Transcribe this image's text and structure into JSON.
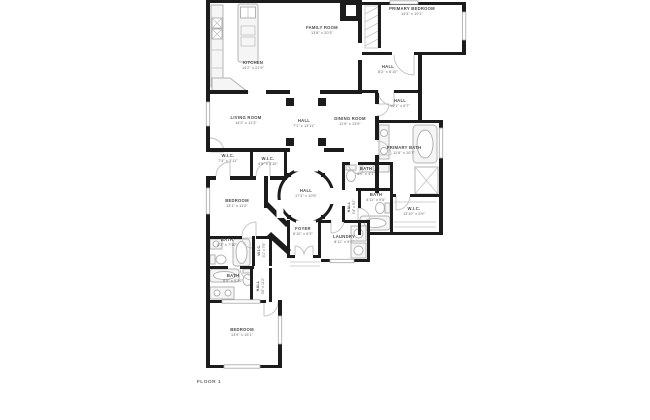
{
  "page": {
    "background": "#ffffff",
    "footer": "FLOOR 1"
  },
  "palette": {
    "wall": "#1c1c1c",
    "fixture_stroke": "#b3b3b3",
    "label": "#4a4a4a",
    "door_arc": "#c0c0c0"
  },
  "floorplan": {
    "type": "residential-floor-plan",
    "level_label": "FLOOR 1",
    "rooms": [
      {
        "name": "KITCHEN",
        "dims": "14'2\" x 21'9\""
      },
      {
        "name": "FAMILY ROOM",
        "dims": "13'8\" x 20'3\""
      },
      {
        "name": "PRIMARY BEDROOM",
        "dims": "14'3\" x 19'1\""
      },
      {
        "name": "HALL",
        "dims": "8'2\" x 6'10\""
      },
      {
        "name": "HALL",
        "dims": "10'1\" x 6'7\""
      },
      {
        "name": "LIVING ROOM",
        "dims": "14'2\" x 11'3\""
      },
      {
        "name": "HALL",
        "dims": "7'1\" x 13'11\""
      },
      {
        "name": "DINING ROOM",
        "dims": "11'9\" x 13'9\""
      },
      {
        "name": "PRIMARY BATH",
        "dims": "11'6\" x 10'7\""
      },
      {
        "name": "W.I.C.",
        "dims": "7'4\" x 3'11\""
      },
      {
        "name": "W.I.C.",
        "dims": "4'5\" x 4'10\""
      },
      {
        "name": "BATH",
        "dims": "8'9\" x 4'1\""
      },
      {
        "name": "HALL",
        "dims": "17'3\" x 10'5\""
      },
      {
        "name": "BATH",
        "dims": "4'11\" x 9'6\""
      },
      {
        "name": "BEDROOM",
        "dims": "13'1\" x 11'0\""
      },
      {
        "name": "W.I.C.",
        "dims": "13'10\" x 5'9\""
      },
      {
        "name": "FOYER",
        "dims": "6'10\" x 6'3\""
      },
      {
        "name": "LAUNDRY",
        "dims": "8'11\" x 9'0\""
      },
      {
        "name": "BATH",
        "dims": "8'3\" x 7'10\""
      },
      {
        "name": "BATH",
        "dims": "8'5\" x 5'10\""
      },
      {
        "name": "BEDROOM",
        "dims": "13'9\" x 15'1\""
      },
      {
        "name": "W.I.C.",
        "dims": "3'1\" x 7'6\""
      },
      {
        "name": "HALL",
        "dims": "3'6\" x 11'2\""
      },
      {
        "name": "HALL",
        "dims": "3'4\" x 9'2\""
      }
    ]
  }
}
